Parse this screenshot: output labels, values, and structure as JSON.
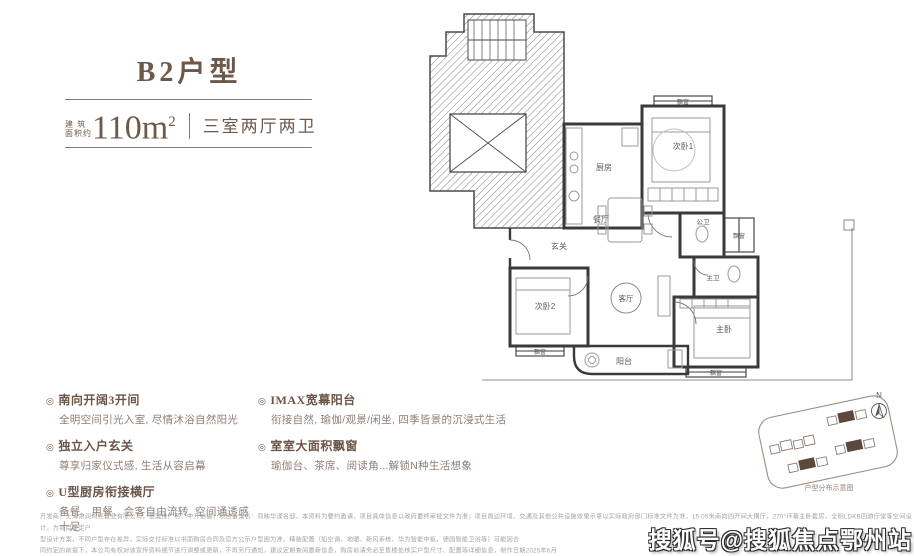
{
  "header": {
    "title": "B2户型",
    "area_label_top": "建 筑",
    "area_label_bottom": "面积约",
    "area_value": "110m",
    "area_exp": "2",
    "layout": "三室两厅两卫"
  },
  "features": {
    "marker": "◎",
    "left": [
      {
        "title": "南向开阔3开间",
        "desc": "全明空间引光入室, 尽情沐浴自然阳光"
      },
      {
        "title": "独立入户玄关",
        "desc": "尊享归家仪式感, 生活从容启幕"
      },
      {
        "title": "U型厨房衔接横厅",
        "desc": "备餐、用餐、会客自由流转, 空间通透感十足"
      }
    ],
    "right": [
      {
        "title": "IMAX宽幕阳台",
        "desc": "衔接自然, 瑜伽/观景/闲坐, 四季皆景的沉浸式生活"
      },
      {
        "title": "室室大面积飘窗",
        "desc": "瑜伽台、茶席、阅读角...解锁N种生活想象"
      }
    ]
  },
  "floorplan": {
    "rooms": {
      "kitchen": "厨房",
      "dining": "餐厅",
      "foyer": "玄关",
      "living": "客厅",
      "bedroom1": "次卧1",
      "bedroom2": "次卧2",
      "master": "主卧",
      "bath_public": "公卫",
      "bath_master": "主卫",
      "balcony": "阳台",
      "bay": "飘窗"
    }
  },
  "siteplan": {
    "caption": "户型分布示意图",
    "compass_n": "N"
  },
  "disclaimer": {
    "lines": [
      "开发商：上海东润鸿熙置业有限公司；整案推广名：中开铂樾；项目备案名：同映华漾名邸、本资料为要约邀请，项目具体信息以政府最终审批文件为准；项目周边环境、交通及其他公共设施效果示意以实际政府部门标准文件为准，15.05米南向四开间大横厅，270°环幕主卧套房，全明LDKB回游厅堂等空间设计，为项目特定户",
      "型设计方案，不同户型存在差异，实际交付标准以书面购房合同及官方公示户型图为准、精装配置（如空调、地暖、新风系统、华为智能中枢、德国智能卫浴等）可能因合",
      "同约定的前提下，本公司有权对该宣传资料细节进行调整或更新，不再另行通知，建议定期查阅最新信息，购房前请务必至售楼处核实户型尺寸、配置等详细信息，制作日期2025年6月"
    ]
  },
  "watermark": "搜狐号@搜狐焦点鄂州站"
}
